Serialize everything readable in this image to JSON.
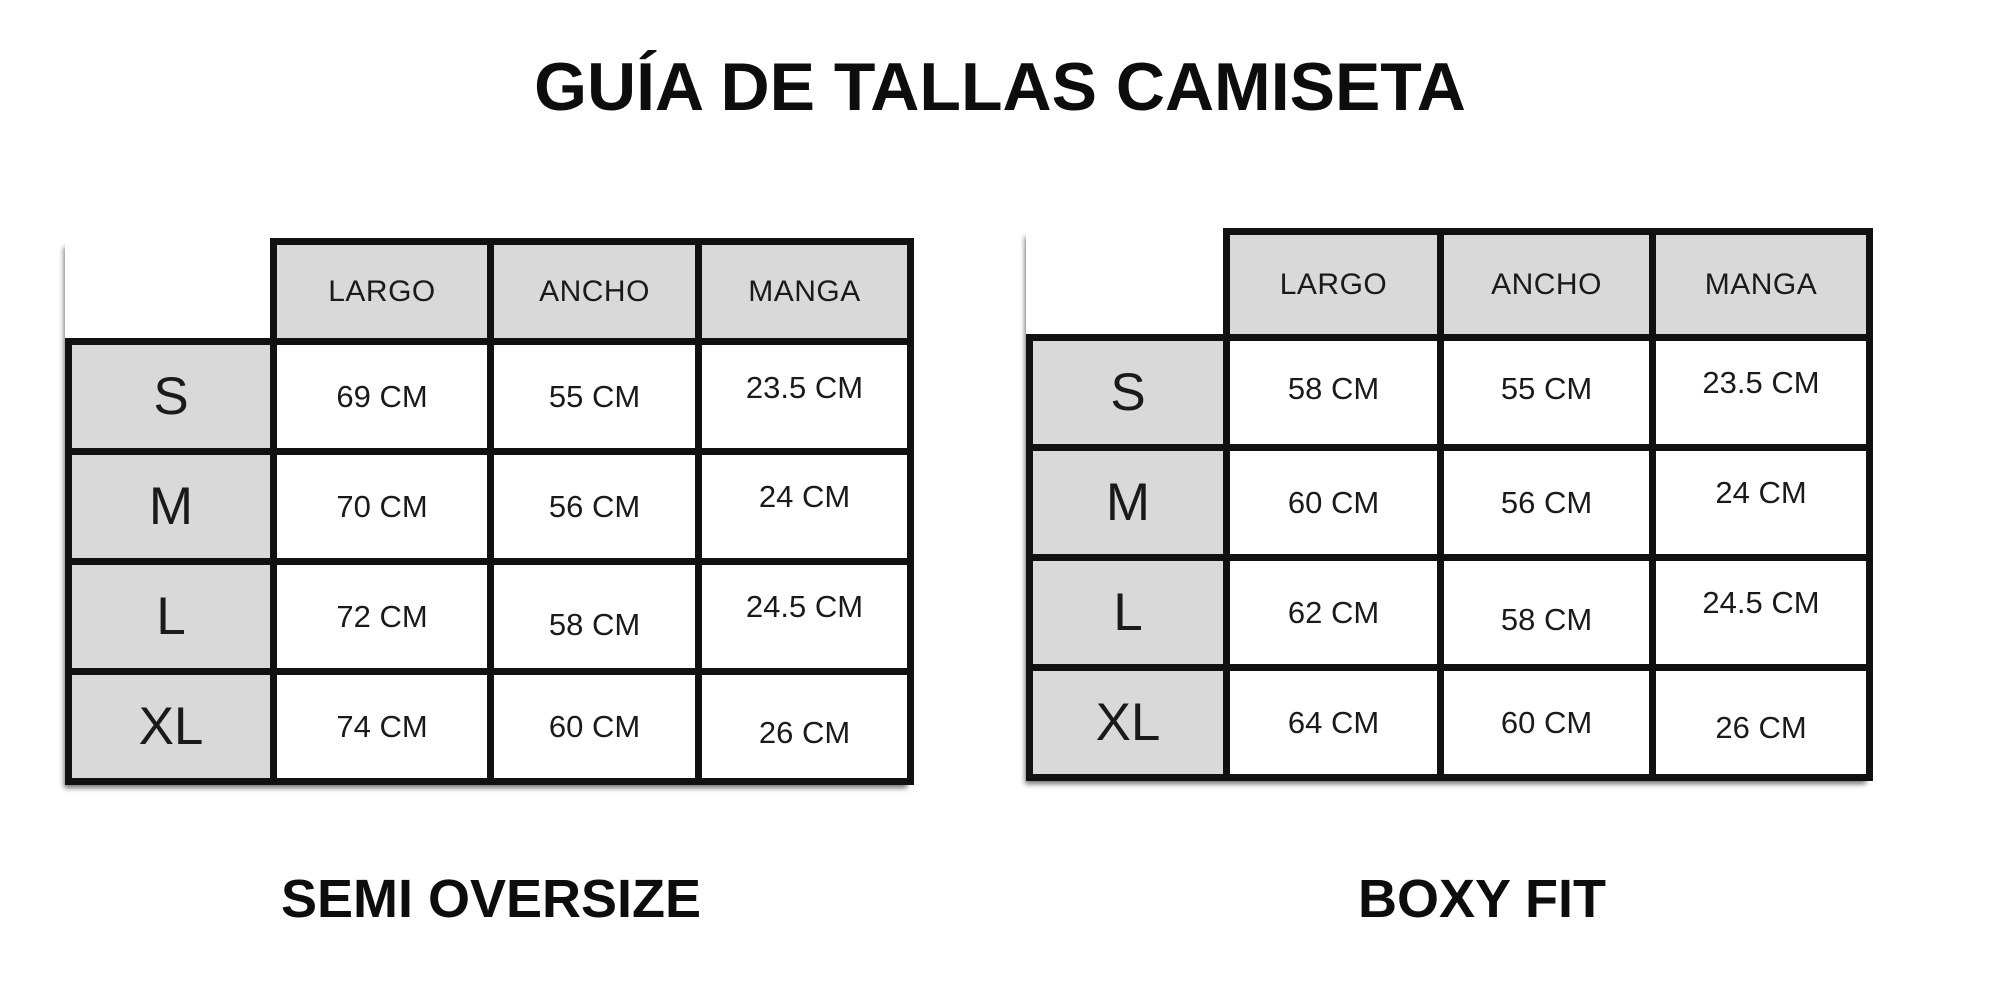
{
  "title": "GUÍA DE TALLAS CAMISETA",
  "colors": {
    "background": "#ffffff",
    "cell_gray": "#d9d9d9",
    "border_black": "#111111",
    "text_black": "#1a1a1a"
  },
  "tables": [
    {
      "caption": "SEMI OVERSIZE",
      "columns": [
        "LARGO",
        "ANCHO",
        "MANGA"
      ],
      "rows": [
        {
          "size": "S",
          "largo": "69 CM",
          "ancho": "55 CM",
          "manga": "23.5 CM"
        },
        {
          "size": "M",
          "largo": "70 CM",
          "ancho": "56 CM",
          "manga": "24 CM"
        },
        {
          "size": "L",
          "largo": "72 CM",
          "ancho": "58 CM",
          "manga": "24.5 CM"
        },
        {
          "size": "XL",
          "largo": "74 CM",
          "ancho": "60 CM",
          "manga": "26 CM"
        }
      ]
    },
    {
      "caption": "BOXY FIT",
      "columns": [
        "LARGO",
        "ANCHO",
        "MANGA"
      ],
      "rows": [
        {
          "size": "S",
          "largo": "58 CM",
          "ancho": "55 CM",
          "manga": "23.5 CM"
        },
        {
          "size": "M",
          "largo": "60 CM",
          "ancho": "56 CM",
          "manga": "24 CM"
        },
        {
          "size": "L",
          "largo": "62 CM",
          "ancho": "58 CM",
          "manga": "24.5 CM"
        },
        {
          "size": "XL",
          "largo": "64 CM",
          "ancho": "60 CM",
          "manga": "26 CM"
        }
      ]
    }
  ]
}
